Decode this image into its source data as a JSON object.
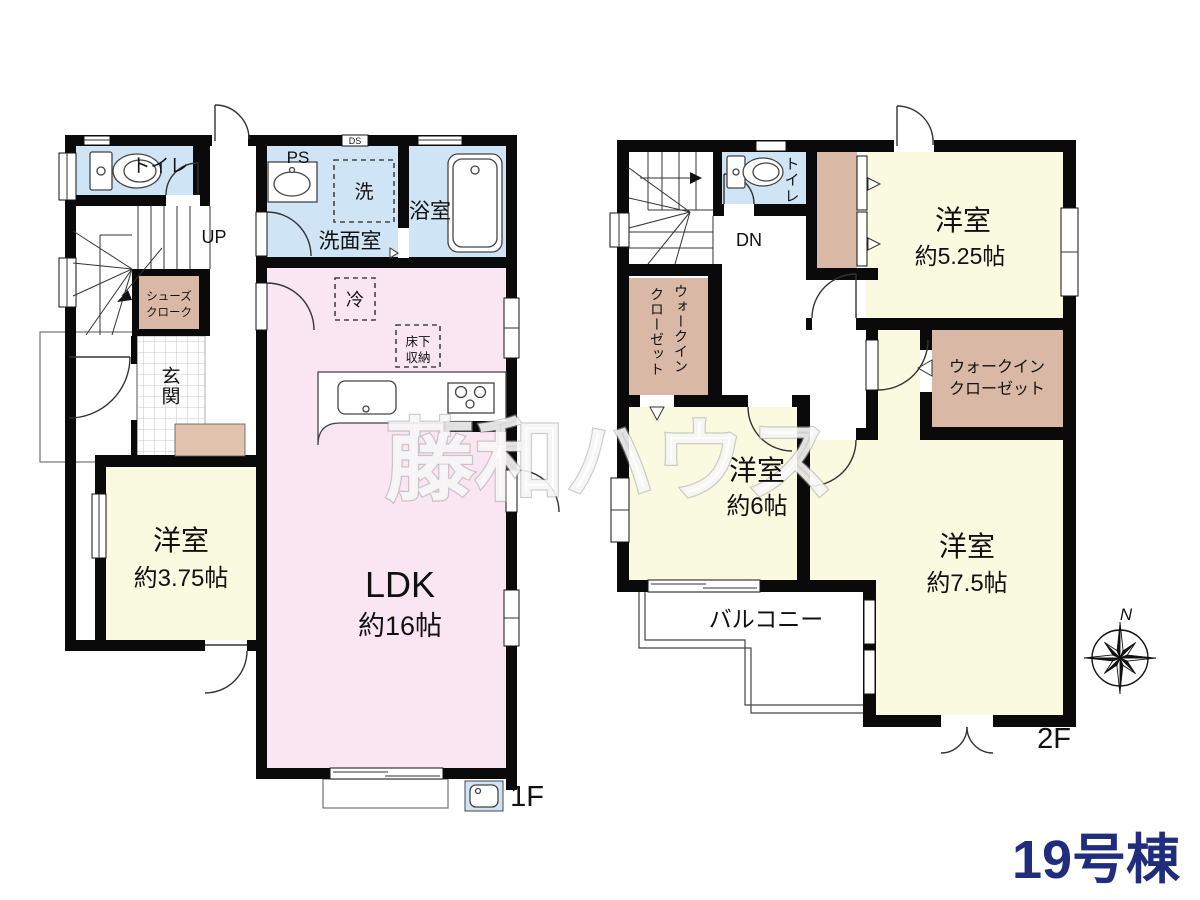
{
  "watermark": "藤和ハウス",
  "unit_label": "19号棟",
  "compass": {
    "north": "N"
  },
  "floor1": {
    "floor_label": "1F",
    "toilet": "トイレ",
    "ps": "PS",
    "ds": "DS",
    "washer": "洗",
    "bathroom": "浴室",
    "washroom": "洗面室",
    "stairs_up": "UP",
    "shoe_closet_line1": "シューズ",
    "shoe_closet_line2": "クローク",
    "entrance": "玄関",
    "fridge": "冷",
    "underfloor_line1": "床下",
    "underfloor_line2": "収納",
    "ldk": "LDK",
    "ldk_size": "約16帖",
    "bedroom": "洋室",
    "bedroom_size": "約3.75帖"
  },
  "floor2": {
    "floor_label": "2F",
    "toilet": "トイレ",
    "stairs_down": "DN",
    "bedroom_a": "洋室",
    "bedroom_a_size": "約5.25帖",
    "wic_left_line1": "ウォークイン",
    "wic_left_line2": "クローゼット",
    "wic_right_line1": "ウォークイン",
    "wic_right_line2": "クローゼット",
    "bedroom_b": "洋室",
    "bedroom_b_size": "約6帖",
    "bedroom_c": "洋室",
    "bedroom_c_size": "約7.5帖",
    "balcony": "バルコニー"
  },
  "colors": {
    "wall": "#0a0a0a",
    "water_room": "#cfe4f5",
    "living": "#fae6f2",
    "bedroom": "#f9fadf",
    "closet": "#d9b9a5",
    "unit_label_color": "#1f2d7c"
  }
}
